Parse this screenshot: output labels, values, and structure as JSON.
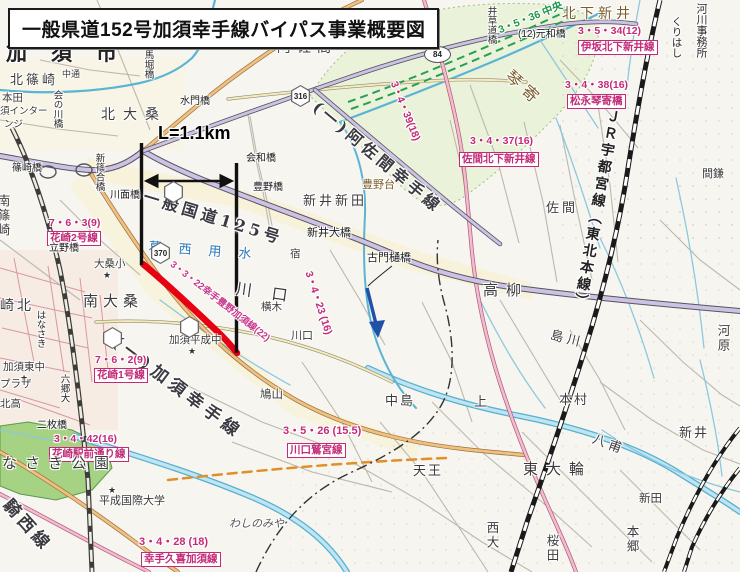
{
  "title": "一般県道152号加須幸手線バイパス事業概要図",
  "colors": {
    "bypass_red": "#e60012",
    "planning_pink": "#c32a78",
    "planned_green": "#1e9648",
    "water_blue": "#6ec0dc"
  },
  "map": {
    "labels": [
      {
        "t": "加須市",
        "x": 6,
        "y": 42,
        "c": "c1",
        "ls": 24,
        "n": "city-label-kazo"
      },
      {
        "t": "北篠崎",
        "x": 10,
        "y": 74,
        "c": "c2",
        "s": 13,
        "ls": 3
      },
      {
        "t": "中通",
        "x": 62,
        "y": 70,
        "c": "c3",
        "s": 9
      },
      {
        "t": "本田",
        "x": 2,
        "y": 93,
        "c": "c3"
      },
      {
        "t": "須インター",
        "x": 0,
        "y": 107,
        "c": "c3",
        "s": 9.5
      },
      {
        "t": "ンジ",
        "x": 4,
        "y": 120,
        "c": "c3",
        "s": 9.5
      },
      {
        "t": "会の川橋",
        "x": 52,
        "y": 90,
        "c": "c10"
      },
      {
        "t": "馬堀橋",
        "x": 143,
        "y": 50,
        "c": "c10"
      },
      {
        "t": "水門橋",
        "x": 180,
        "y": 97,
        "c": "c4"
      },
      {
        "t": "北大桑",
        "x": 101,
        "y": 108,
        "c": "c2",
        "s": 14,
        "ls": 8
      },
      {
        "t": "阿佐間",
        "x": 277,
        "y": 41,
        "c": "c2",
        "s": 14,
        "ls": 6
      },
      {
        "t": "井草道橋",
        "x": 486,
        "y": 6,
        "c": "c10"
      },
      {
        "t": "北下新井",
        "x": 562,
        "y": 7,
        "c": "c7",
        "s": 14,
        "ls": 4
      },
      {
        "t": "3・5・34(12)",
        "x": 578,
        "y": 26,
        "c": "c5"
      },
      {
        "t": "伊坂北下新井線",
        "x": 578,
        "y": 40,
        "c": "c6"
      },
      {
        "t": "(12)元和橋",
        "x": 518,
        "y": 30,
        "c": "c4"
      },
      {
        "t": "3・5・36 中央",
        "x": 497,
        "y": 26,
        "c": "c15",
        "r": -22
      },
      {
        "t": "くりはし",
        "x": 671,
        "y": 16,
        "c": "c10",
        "s": 10.5
      },
      {
        "t": "河川事務所",
        "x": 695,
        "y": 3,
        "c": "c10",
        "s": 11
      },
      {
        "t": "琴寄",
        "x": 513,
        "y": 68,
        "c": "c7",
        "s": 16,
        "ls": 6,
        "r": 42
      },
      {
        "t": "3・4・39(18)",
        "x": 398,
        "y": 80,
        "c": "c5",
        "r": 68
      },
      {
        "t": "3・4・38(16)",
        "x": 565,
        "y": 80,
        "c": "c5"
      },
      {
        "t": "松永琴寄橋",
        "x": 567,
        "y": 94,
        "c": "c6"
      },
      {
        "t": "3・4・37(16)",
        "x": 470,
        "y": 136,
        "c": "c5"
      },
      {
        "t": "佐間北下新井線",
        "x": 459,
        "y": 152,
        "c": "c6"
      },
      {
        "t": "(一)阿佐間幸手線",
        "x": 320,
        "y": 99,
        "c": "c8",
        "r": 40,
        "n": "asama-satte-line-label"
      },
      {
        "t": "会和橋",
        "x": 246,
        "y": 154,
        "c": "c4"
      },
      {
        "t": "豊野橋",
        "x": 253,
        "y": 183,
        "c": "c4"
      },
      {
        "t": "豊野台",
        "x": 362,
        "y": 179,
        "c": "c7",
        "s": 11
      },
      {
        "t": "新井新田",
        "x": 303,
        "y": 195,
        "c": "c2",
        "s": 13,
        "ls": 3
      },
      {
        "t": "一般国道125号",
        "x": 146,
        "y": 189,
        "c": "c8",
        "r": 17,
        "n": "route125-label"
      },
      {
        "t": "L=1.1km",
        "x": 158,
        "y": 124,
        "c": "c12",
        "n": "length-annotation"
      },
      {
        "t": "新篠合橋",
        "x": 94,
        "y": 153,
        "c": "c10"
      },
      {
        "t": "川面橋",
        "x": 110,
        "y": 191,
        "c": "c4"
      },
      {
        "t": "篠崎橋",
        "x": 12,
        "y": 164,
        "c": "c4"
      },
      {
        "t": "南篠崎",
        "x": -4,
        "y": 194,
        "c": "c16"
      },
      {
        "t": "7・6・3(9)",
        "x": 49,
        "y": 218,
        "c": "c5"
      },
      {
        "t": "花崎2号線",
        "x": 47,
        "y": 231,
        "c": "c6"
      },
      {
        "t": "立野橋",
        "x": 49,
        "y": 244,
        "c": "c4"
      },
      {
        "t": "大桑小",
        "x": 94,
        "y": 259,
        "c": "c3"
      },
      {
        "t": "★",
        "x": 103,
        "y": 271,
        "c": "c17"
      },
      {
        "t": "葛西用水",
        "x": 149,
        "y": 241,
        "c": "c9",
        "ls": 17,
        "r": 4,
        "n": "kasai-canal-label"
      },
      {
        "t": "宿",
        "x": 290,
        "y": 249,
        "c": "c3"
      },
      {
        "t": "南大桑",
        "x": 83,
        "y": 294,
        "c": "c2",
        "s": 15,
        "ls": 5
      },
      {
        "t": "(一)加須幸手線",
        "x": 119,
        "y": 334,
        "c": "c8",
        "s": 17,
        "ls": 5,
        "r": 37,
        "n": "kazo-satte-line-label"
      },
      {
        "t": "崎北",
        "x": 0,
        "y": 299,
        "c": "c2",
        "s": 14,
        "ls": 3
      },
      {
        "t": "はなさき",
        "x": 35,
        "y": 310,
        "c": "c10"
      },
      {
        "t": "加須東中",
        "x": 3,
        "y": 362,
        "c": "c3"
      },
      {
        "t": "★",
        "x": 20,
        "y": 374,
        "c": "c17"
      },
      {
        "t": "六郷大",
        "x": 59,
        "y": 374,
        "c": "c10"
      },
      {
        "t": "プラザ",
        "x": 0,
        "y": 379,
        "c": "c3"
      },
      {
        "t": "北高",
        "x": 0,
        "y": 399,
        "c": "c3"
      },
      {
        "t": "7・6・2(9)",
        "x": 95,
        "y": 355,
        "c": "c5"
      },
      {
        "t": "花崎1号線",
        "x": 94,
        "y": 368,
        "c": "c6"
      },
      {
        "t": "加須平成中",
        "x": 169,
        "y": 335,
        "c": "c3"
      },
      {
        "t": "★",
        "x": 188,
        "y": 347,
        "c": "c17"
      },
      {
        "t": "鳩山",
        "x": 260,
        "y": 390,
        "c": "c3",
        "s": 11.5
      },
      {
        "t": "3・3・22幸手豊野加須線(22)",
        "x": 174,
        "y": 260,
        "c": "c13",
        "r": 38,
        "n": "bypass-route-name"
      },
      {
        "t": "川口",
        "x": 237,
        "y": 281,
        "c": "c2",
        "s": 16,
        "ls": 20,
        "r": 8
      },
      {
        "t": "横木",
        "x": 261,
        "y": 302,
        "c": "c3"
      },
      {
        "t": "川口",
        "x": 291,
        "y": 331,
        "c": "c3",
        "s": 11
      },
      {
        "t": "3・4・23 (16)",
        "x": 313,
        "y": 270,
        "c": "c5",
        "r": 72
      },
      {
        "t": "新井大橋",
        "x": 307,
        "y": 228,
        "c": "c4",
        "s": 11
      },
      {
        "t": "古門樋橋",
        "x": 367,
        "y": 253,
        "c": "c4",
        "s": 11
      },
      {
        "t": "佐間",
        "x": 546,
        "y": 202,
        "c": "c2",
        "s": 13,
        "ls": 3
      },
      {
        "t": "ＪＲ宇都宮線（東北本線）",
        "x": 608,
        "y": 108,
        "c": "c11",
        "r": 10,
        "n": "jr-utsunomiya-line-label"
      },
      {
        "t": "間鎌",
        "x": 702,
        "y": 169,
        "c": "c3",
        "s": 11
      },
      {
        "t": "高柳",
        "x": 483,
        "y": 283,
        "c": "c2",
        "ls": 8
      },
      {
        "t": "島川",
        "x": 552,
        "y": 329,
        "c": "c2",
        "s": 13,
        "ls": 4,
        "r": 14
      },
      {
        "t": "河原",
        "x": 716,
        "y": 324,
        "c": "c16"
      },
      {
        "t": "中島",
        "x": 385,
        "y": 395,
        "c": "c2",
        "s": 13,
        "ls": 2
      },
      {
        "t": "上",
        "x": 474,
        "y": 396,
        "c": "c2",
        "s": 13
      },
      {
        "t": "本村",
        "x": 559,
        "y": 394,
        "c": "c2",
        "s": 13,
        "ls": 2
      },
      {
        "t": "3・5・26 (15.5)",
        "x": 283,
        "y": 426,
        "c": "c5",
        "s": 11
      },
      {
        "t": "川口鷲宮線",
        "x": 287,
        "y": 443,
        "c": "c6"
      },
      {
        "t": "わしのみや",
        "x": 229,
        "y": 519,
        "c": "c14"
      },
      {
        "t": "二枚橋",
        "x": 37,
        "y": 421,
        "c": "c4"
      },
      {
        "t": "3・4・42(16)",
        "x": 54,
        "y": 434,
        "c": "c5"
      },
      {
        "t": "花崎駅前通り線",
        "x": 49,
        "y": 447,
        "c": "c6"
      },
      {
        "t": "なさき公園",
        "x": 2,
        "y": 456,
        "c": "c2",
        "s": 15,
        "ls": 8
      },
      {
        "t": "平成国際大学",
        "x": 99,
        "y": 496,
        "c": "c3",
        "s": 11
      },
      {
        "t": "★",
        "x": 108,
        "y": 486,
        "c": "c17"
      },
      {
        "t": "騎西線",
        "x": 12,
        "y": 497,
        "c": "c8",
        "s": 17,
        "r": 48,
        "n": "kisai-line-label"
      },
      {
        "t": "3・4・28 (18)",
        "x": 139,
        "y": 537,
        "c": "c5",
        "s": 11
      },
      {
        "t": "幸手久喜加須線",
        "x": 141,
        "y": 552,
        "c": "c6"
      },
      {
        "t": "天王",
        "x": 413,
        "y": 465,
        "c": "c2",
        "s": 13,
        "ls": 2
      },
      {
        "t": "東大輪",
        "x": 523,
        "y": 462,
        "c": "c2",
        "ls": 8
      },
      {
        "t": "八甫",
        "x": 595,
        "y": 433,
        "c": "c2",
        "s": 13,
        "ls": 4,
        "r": 20
      },
      {
        "t": "新井",
        "x": 679,
        "y": 427,
        "c": "c2",
        "s": 13,
        "ls": 2
      },
      {
        "t": "新田",
        "x": 639,
        "y": 494,
        "c": "c3",
        "s": 11.5
      },
      {
        "t": "本郷",
        "x": 625,
        "y": 525,
        "c": "c16"
      },
      {
        "t": "西大",
        "x": 485,
        "y": 521,
        "c": "c16"
      },
      {
        "t": "桜田",
        "x": 545,
        "y": 534,
        "c": "c16"
      }
    ],
    "shields": [
      {
        "num": "84",
        "x": 424,
        "y": 46,
        "shape": "oval"
      },
      {
        "num": "316",
        "x": 291,
        "y": 85,
        "shape": "hex"
      },
      {
        "num": "370",
        "x": 151,
        "y": 242,
        "shape": "hex"
      },
      {
        "num": "",
        "x": 164,
        "y": 181,
        "shape": "hex"
      },
      {
        "num": "",
        "x": 180,
        "y": 316,
        "shape": "hex"
      },
      {
        "num": "",
        "x": 103,
        "y": 327,
        "shape": "hex"
      }
    ]
  }
}
